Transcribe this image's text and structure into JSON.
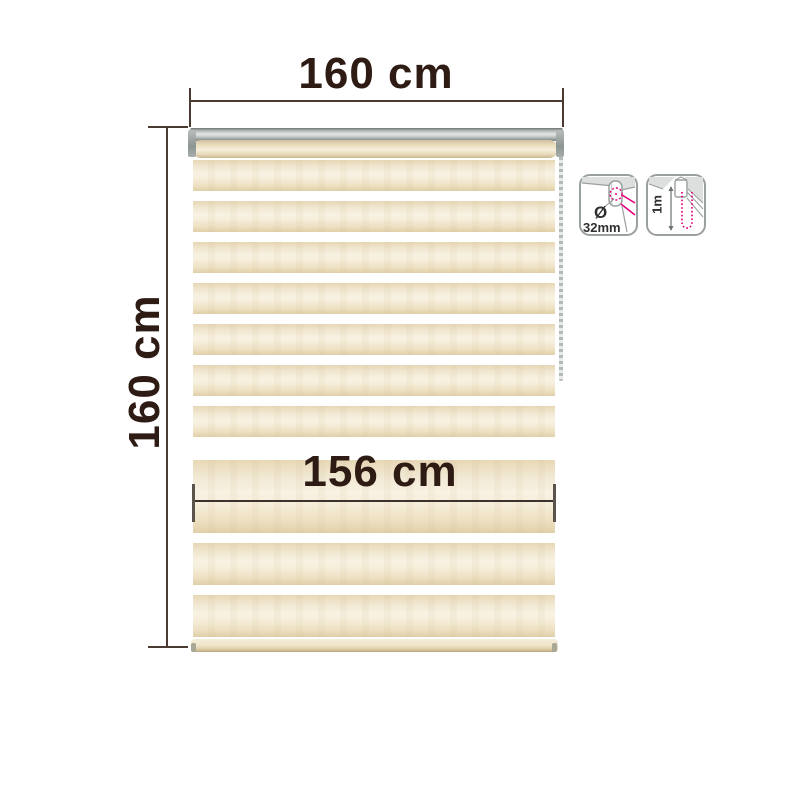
{
  "diagram": {
    "top_width_label": "160 cm",
    "side_height_label": "160 cm",
    "fabric_width_label": "156 cm"
  },
  "icons": {
    "tube": {
      "diameter_symbol": "Ø",
      "diameter_value": "32mm"
    },
    "chain": {
      "length_value": "1m"
    }
  },
  "colors": {
    "dimension_text": "#2e1c14",
    "dimension_line": "#4a3a32",
    "stripe_cream": "#f2e7cf",
    "rail_silver": "#cfd4d2",
    "accent_magenta": "#e6017d",
    "icon_outline_gray": "#9aa09f"
  }
}
